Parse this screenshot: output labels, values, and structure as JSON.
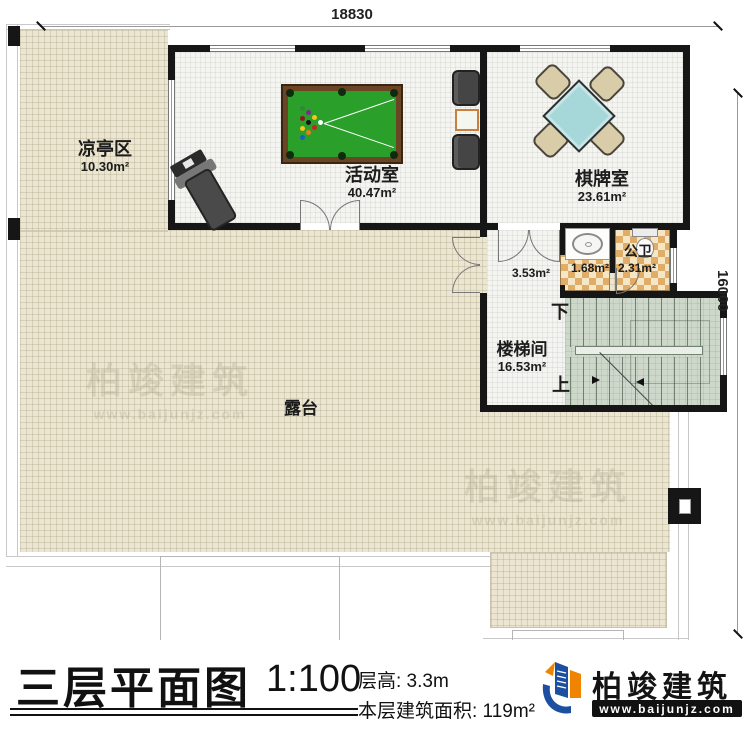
{
  "dimensions": {
    "top": "18830",
    "right": "16000"
  },
  "rooms": {
    "pavilion": {
      "name": "凉亭区",
      "area": "10.30m²"
    },
    "activity": {
      "name": "活动室",
      "area": "40.47m²"
    },
    "chess": {
      "name": "棋牌室",
      "area": "23.61m²"
    },
    "wash": {
      "area": "1.68m²"
    },
    "bath": {
      "name": "公卫",
      "area": "2.31m²"
    },
    "hall": {
      "area": "3.53m²"
    },
    "stairwell": {
      "name": "楼梯间",
      "area": "16.53m²"
    },
    "terrace": {
      "name": "露台"
    }
  },
  "stairs": {
    "down": "下",
    "up": "上"
  },
  "titleblock": {
    "title": "三层平面图",
    "scale": "1:100",
    "floor_height": "层高: 3.3m",
    "floor_area": "本层建筑面积: 119m²"
  },
  "brand": {
    "name": "柏竣建筑",
    "url": "www.baijunjz.com"
  },
  "watermark": {
    "text": "柏竣建筑",
    "url": "www.baijunjz.com"
  },
  "colors": {
    "terrace": "#ece5d1",
    "room_floor": "#f4f4f1",
    "stair_floor": "#cdd7ca",
    "tile_dark": "#e0ad68",
    "tile_light": "#f5e7c5",
    "wall": "#161616",
    "pool_green": "#2aa02a",
    "pool_wood": "#6b4423",
    "mahjong_table": "#a6d7d9",
    "chair": "#d9cca8",
    "logo_blue": "#1d4fa1",
    "logo_orange": "#f08300"
  }
}
